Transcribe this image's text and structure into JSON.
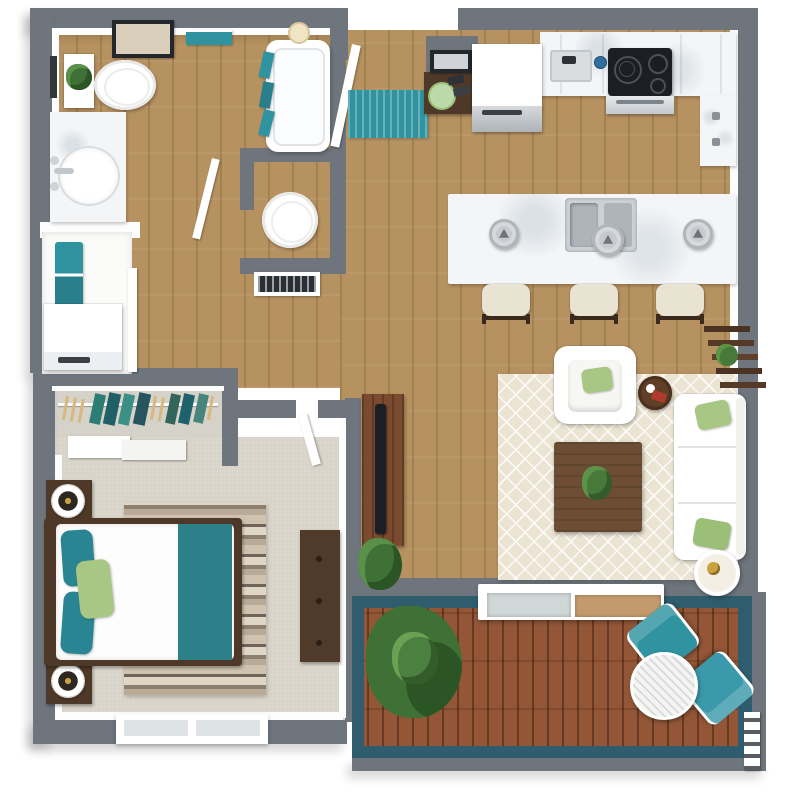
{
  "palette": {
    "wall": "#6e757d",
    "wood": "#b79261",
    "carpet": "#d8d4c9",
    "closet-carpet": "#d5d2c9",
    "deck-wood": "#935737",
    "deck-wall": "#2f5d6e",
    "teal": "#2f93a0",
    "teal-deep": "#2a7f8c",
    "green": "#a8c684",
    "plant": "#46793a",
    "marble": "#f3f5f7",
    "dark-wood": "#4e3827",
    "walnut": "#6d4e35",
    "rug-cream": "#ebe4d2",
    "metal": "#c7cbcf",
    "gold": "#c9a23f",
    "black": "#1b1e22"
  },
  "rooms": {
    "bathroom": {
      "items": [
        "wall-art",
        "towel-bar",
        "toilet",
        "plant-shelf",
        "marble-vanity",
        "oval-sink",
        "bathtub",
        "shower-head",
        "hanging-towels"
      ]
    },
    "water_closet": {
      "items": [
        "round-toilet",
        "framed-art",
        "door"
      ]
    },
    "laundry_closet": {
      "items": [
        "folded-teal-towels",
        "washer",
        "door"
      ]
    },
    "entry": {
      "items": [
        "open-entry-door",
        "teal-runner-rug",
        "console-table",
        "wall-art",
        "green-plate"
      ]
    },
    "kitchen": {
      "items": [
        "refrigerator",
        "countertop",
        "prep-sink",
        "cooktop",
        "oven",
        "pantry-cabinet",
        "island",
        "double-sink",
        "pendant-light",
        "bar-stool"
      ],
      "pendant_count": 3,
      "stool_count": 3
    },
    "wardrobe": {
      "items": [
        "hanging-rod",
        "garments",
        "wood-hangers",
        "sliding-doors"
      ]
    },
    "bedroom": {
      "items": [
        "bed",
        "teal-pillows",
        "green-pillow",
        "teal-foot-runner",
        "striped-rug",
        "nightstand",
        "table-lamp",
        "dresser",
        "window",
        "door"
      ],
      "nightstand_count": 2
    },
    "living_room": {
      "items": [
        "lattice-area-rug",
        "armchair",
        "green-throw-pillows",
        "round-side-table",
        "coffee-table",
        "potted-plant",
        "sofa",
        "ladder-shelf",
        "lamp-side-table",
        "tv-console",
        "tv",
        "floor-plant"
      ]
    },
    "deck": {
      "items": [
        "sliding-glass-door",
        "large-potted-plant",
        "teal-lounge-chair",
        "round-slat-table",
        "access-ladder"
      ],
      "lounge_chair_count": 2
    }
  }
}
